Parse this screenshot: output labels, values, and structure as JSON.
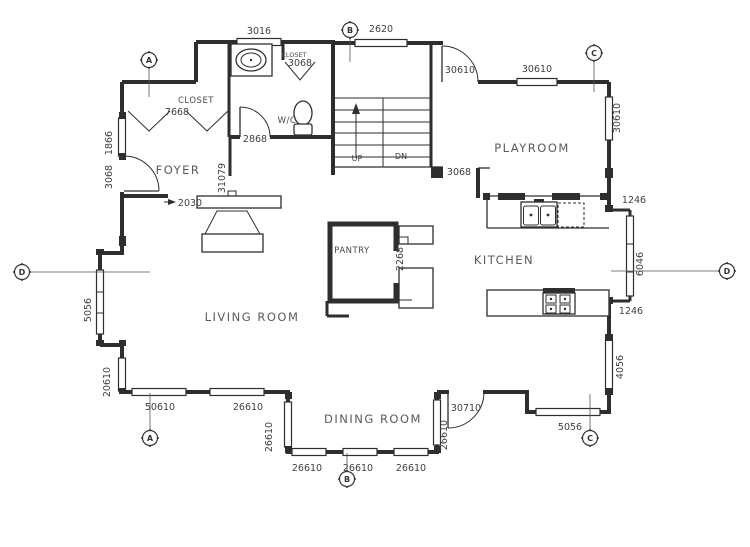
{
  "drawing": {
    "background": "#ffffff",
    "line_color": "#2e2e2e",
    "text_color": "#4a4a4a"
  },
  "rooms": {
    "foyer": "FOYER",
    "closet": "CLOSET",
    "wc": "W/C",
    "bath_closet": "CLOSET",
    "playroom": "PLAYROOM",
    "kitchen": "KITCHEN",
    "pantry": "PANTRY",
    "living_room": "LIVING ROOM",
    "dining_room": "DINING ROOM"
  },
  "stairs": {
    "up": "UP",
    "down": "DN"
  },
  "dims": {
    "d3016": "3016",
    "d2620": "2620",
    "d30610_door": "30610",
    "d30610_win_n": "30610",
    "d30610_win_e": "30610",
    "d7668": "7668",
    "d3068_bathcloset": "3068",
    "d2868": "2868",
    "d31079": "31079",
    "d2030": "2030",
    "d1866": "1866",
    "d3068_front": "3068",
    "d3068_kitchen": "3068",
    "d1246_top": "1246",
    "d6046": "6046",
    "d1246_bottom": "1246",
    "d4056": "4056",
    "d5056_se": "5056",
    "d5056_w": "5056",
    "d20610": "20610",
    "d50610": "50610",
    "d26610_s_living": "26610",
    "d26610_dining_left": "26610",
    "d26610_s1": "26610",
    "d26610_s2": "26610",
    "d26610_s3": "26610",
    "d26610_dining_right": "26610",
    "d30710": "30710",
    "d2268": "2268"
  },
  "markers": {
    "a_top": "A",
    "b_top": "B",
    "c_top": "C",
    "d_left": "D",
    "d_right": "D",
    "a_bottom": "A",
    "b_bottom": "B",
    "c_bottom": "C"
  }
}
